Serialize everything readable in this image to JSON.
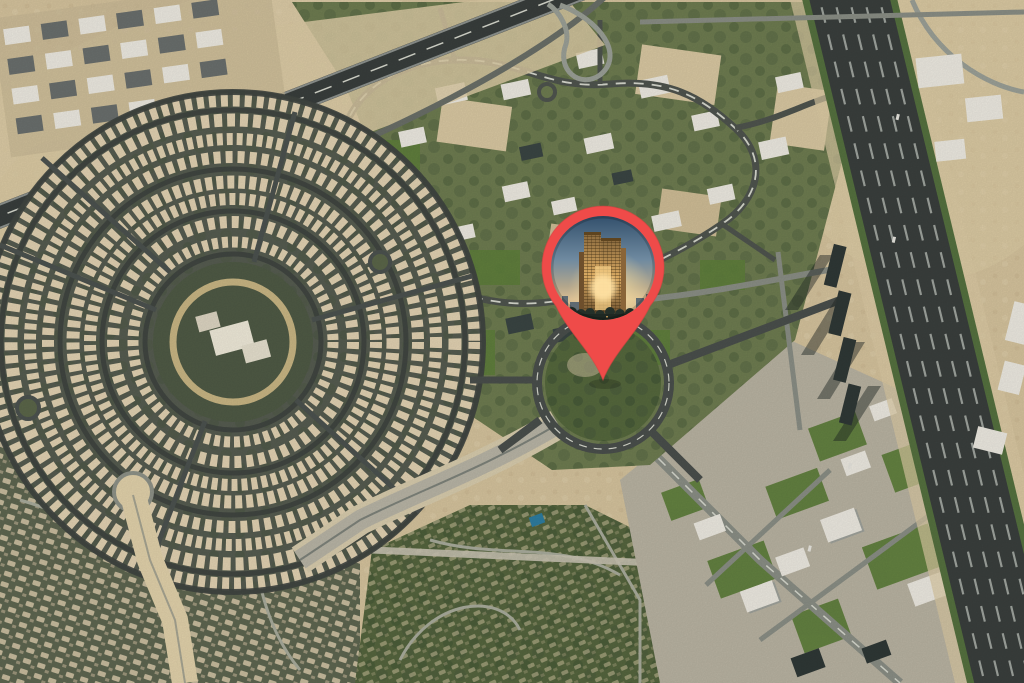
{
  "app": {
    "name": "Satellite map with location marker"
  },
  "marker": {
    "name": "location-pin",
    "kind": "map-pin-with-photo",
    "pin_color": "#EF4B49",
    "pin_edge_color": "#D84341",
    "photo": {
      "description": "golden high-rise tower at dusk",
      "sky_top": "#33506C",
      "sky_mid": "#7E95A7",
      "horizon": "#D9BE93",
      "glow": "#FFE2A4",
      "tower_light": "#F4CE86",
      "tower_dark": "#6E4F2C",
      "skyline": "#51616E",
      "foreground_dark": "#1E2822"
    }
  },
  "map": {
    "type": "satellite-imagery",
    "palette": {
      "sand": "#D5C39D",
      "sand_light": "#E4D4AF",
      "sand_dark": "#C2AE86",
      "green": "#6E7C50",
      "green_bright": "#5F7F3C",
      "green_dark": "#46563A",
      "road": "#4F544E",
      "road_light": "#9BA097",
      "asphalt": "#3A3F3D",
      "lane_stripe": "#D7D9CE",
      "building_white": "#EDEAE1",
      "building_gray": "#9FA29B",
      "building_dark": "#2F3836",
      "villa": "#E2D2B2"
    }
  }
}
